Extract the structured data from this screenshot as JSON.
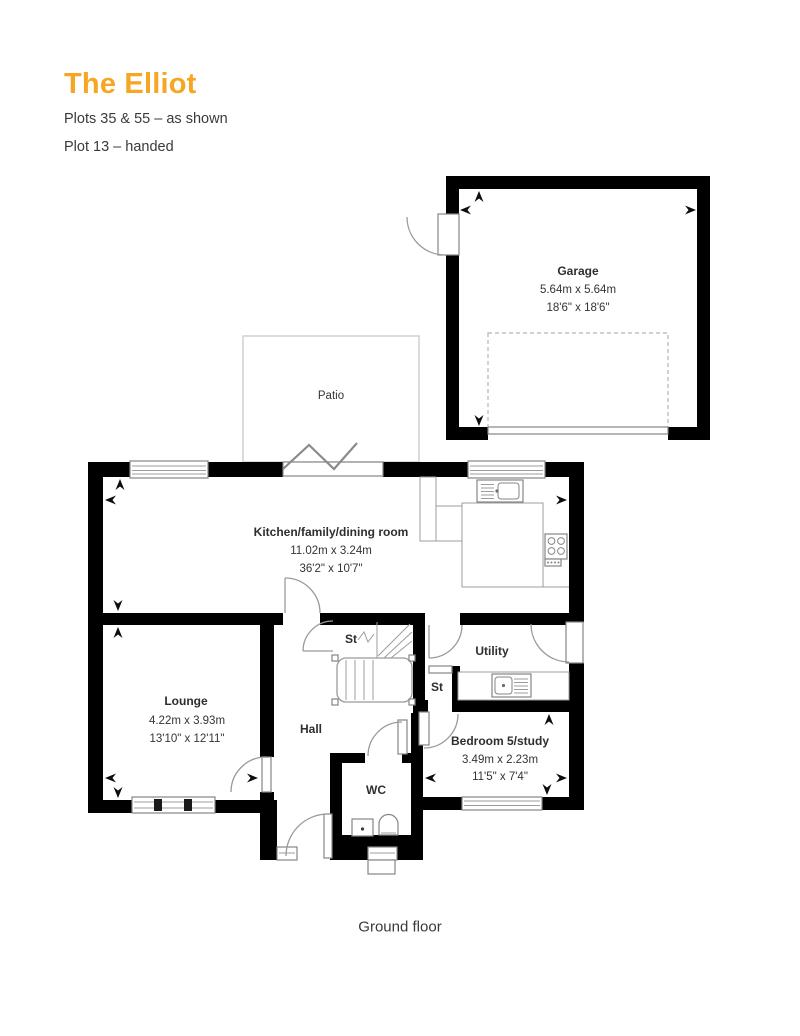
{
  "header": {
    "title": "The Elliot",
    "plots_line1": "Plots 35 & 55 – as shown",
    "plots_line2": "Plot 13 – handed"
  },
  "floor_label": "Ground floor",
  "rooms": {
    "garage": {
      "name": "Garage",
      "metric": "5.64m x 5.64m",
      "imperial": "18'6\" x 18'6\""
    },
    "patio": {
      "name": "Patio"
    },
    "kitchen": {
      "name": "Kitchen/family/dining room",
      "metric": "11.02m x 3.24m",
      "imperial": "36'2\" x 10'7\""
    },
    "lounge": {
      "name": "Lounge",
      "metric": "4.22m x 3.93m",
      "imperial": "13'10\" x 12'11\""
    },
    "hall": {
      "name": "Hall"
    },
    "store_1": {
      "name": "St"
    },
    "store_2": {
      "name": "St"
    },
    "utility": {
      "name": "Utility"
    },
    "bedroom_5": {
      "name": "Bedroom 5/study",
      "metric": "3.49m x 2.23m",
      "imperial": "11'5\" x 7'4\""
    },
    "wc": {
      "name": "WC"
    }
  },
  "colors": {
    "accent": "#F6A623",
    "wall": "#000000",
    "text": "#3A3A38",
    "frame": "#8E8E8E"
  }
}
